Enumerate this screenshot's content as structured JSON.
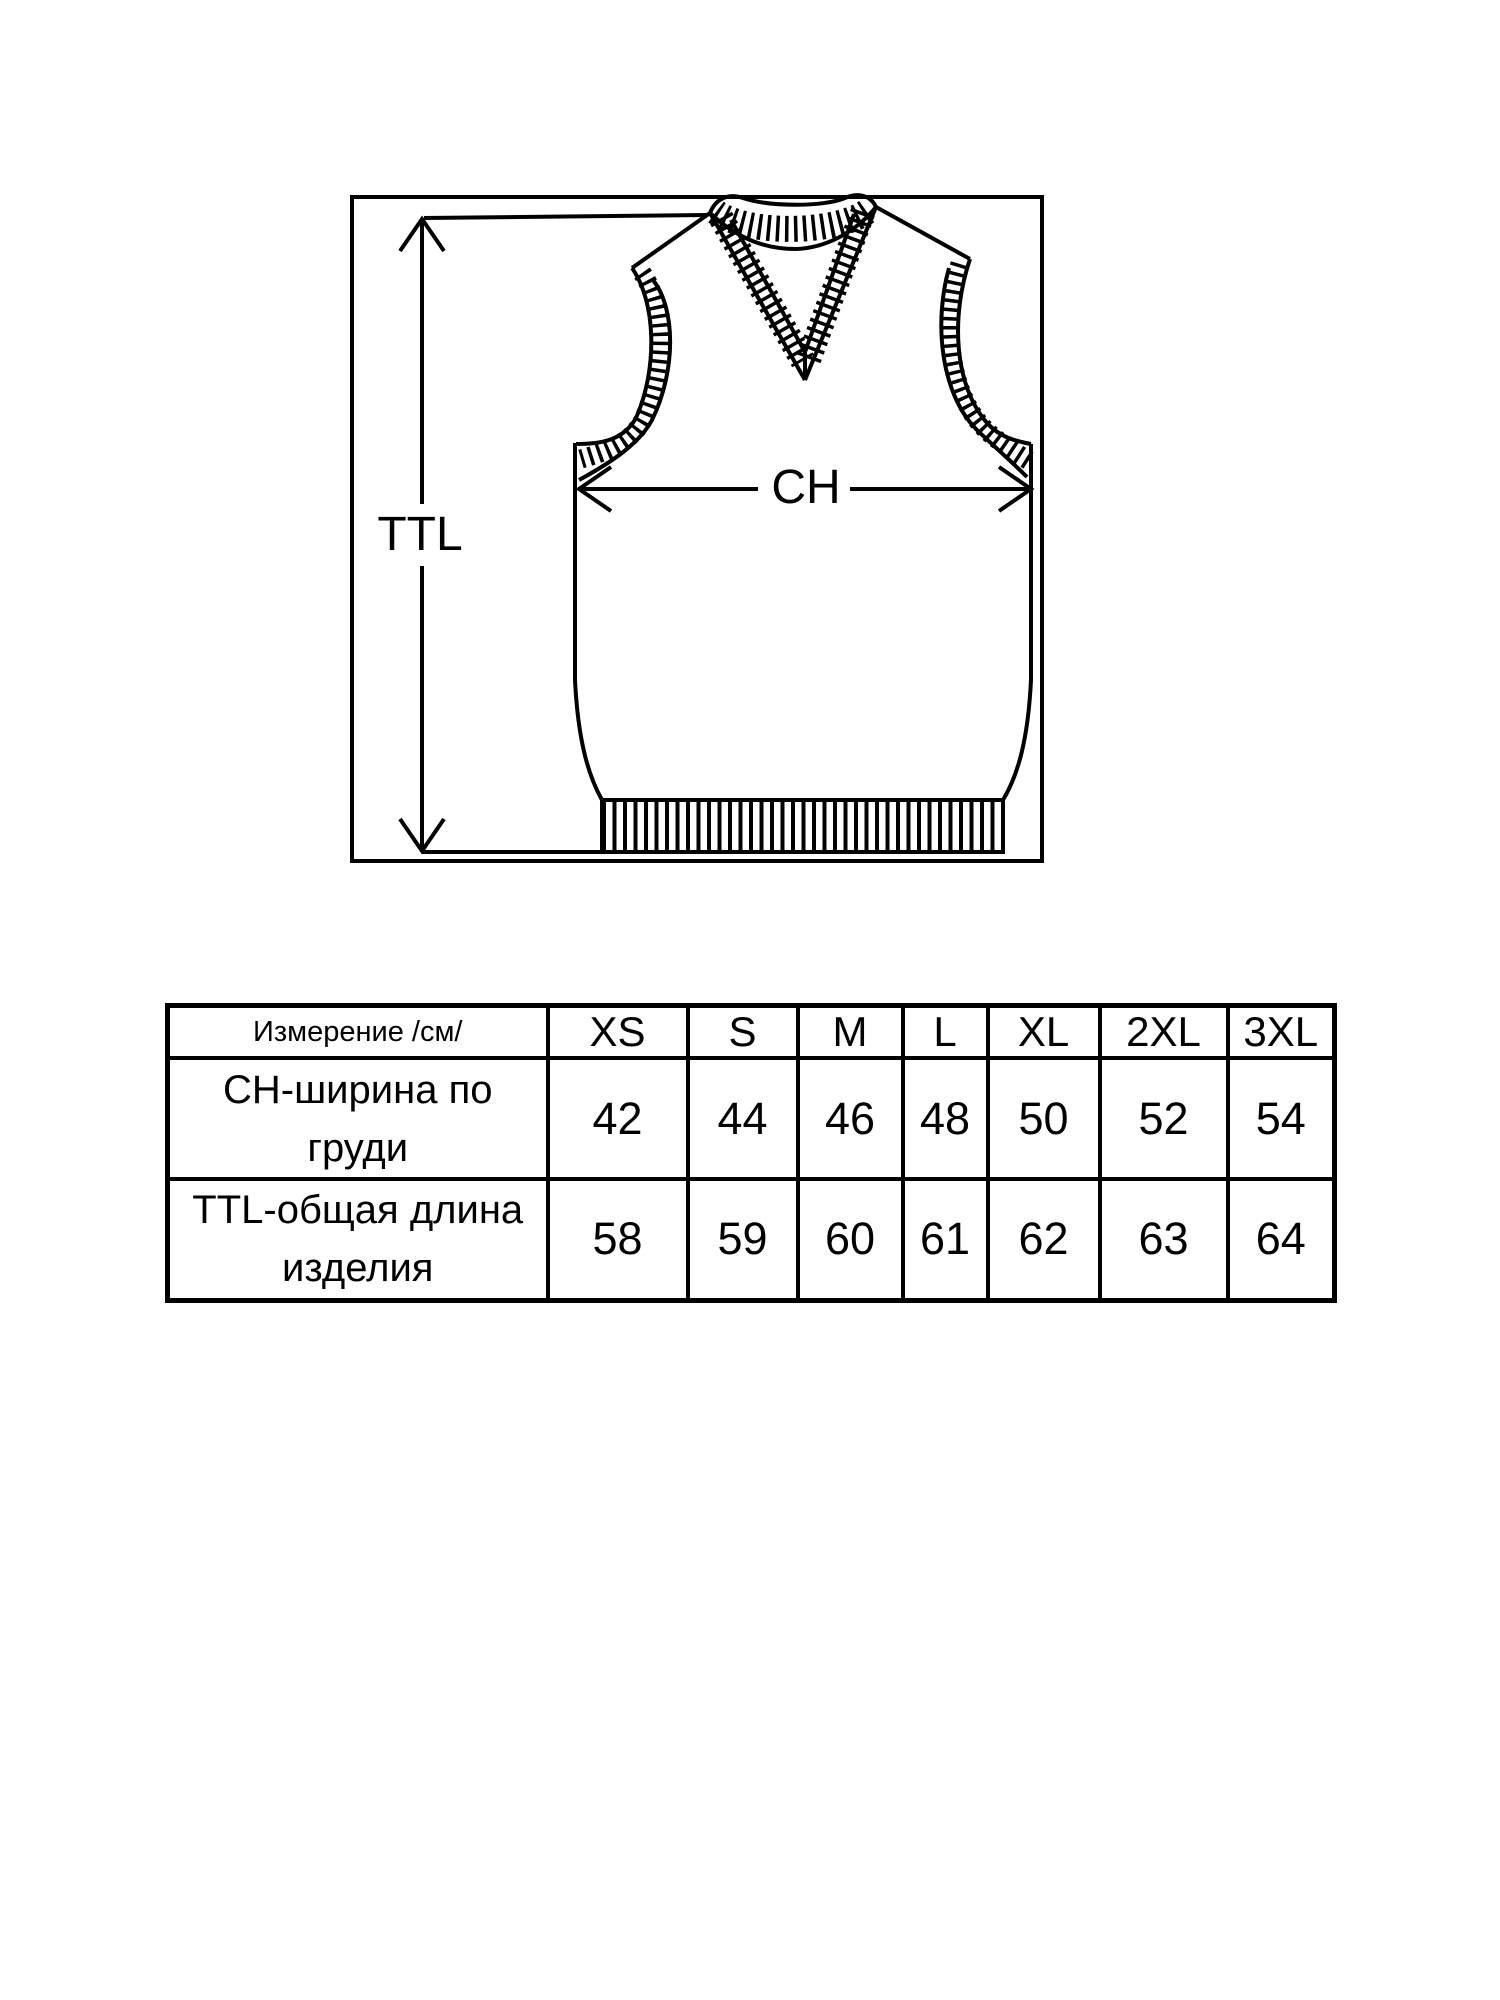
{
  "page": {
    "background_color": "#ffffff",
    "ink_color": "#000000"
  },
  "diagram": {
    "ttl_label": "TTL",
    "ch_label": "CH"
  },
  "table": {
    "header": {
      "measure_label": "Измерение /см/",
      "sizes": [
        "XS",
        "S",
        "M",
        "L",
        "XL",
        "2XL",
        "3XL"
      ]
    },
    "rows": [
      {
        "label": "CH-ширина по груди",
        "values": [
          42,
          44,
          46,
          48,
          50,
          52,
          54
        ]
      },
      {
        "label": "TTL-общая длина изделия",
        "values": [
          58,
          59,
          60,
          61,
          62,
          63,
          64
        ]
      }
    ]
  }
}
